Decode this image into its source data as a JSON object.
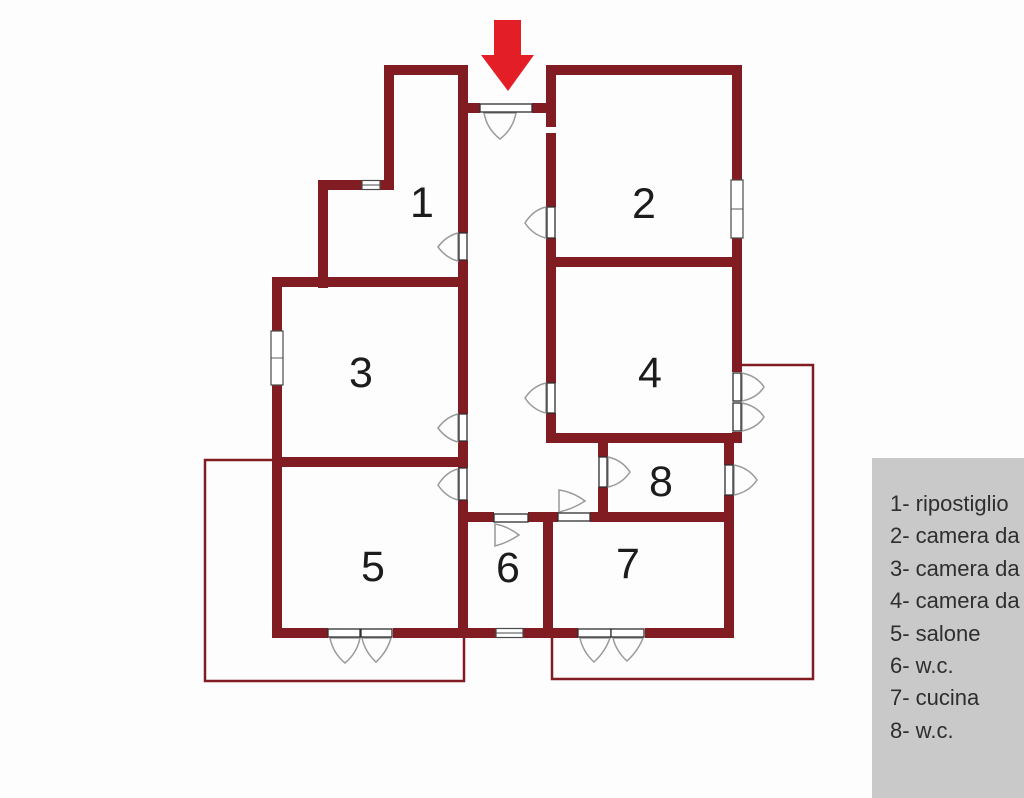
{
  "floorplan": {
    "background": "#fdfdfd",
    "wall_color": "#821c23",
    "arrow_color": "#e31e26",
    "room_numbers": [
      "1",
      "2",
      "3",
      "4",
      "5",
      "6",
      "7",
      "8"
    ]
  },
  "legend": {
    "background": "#c9c9c9",
    "text_color": "#2e2e2e",
    "items": [
      "1- ripostiglio",
      "2- camera da",
      "3- camera da",
      "4- camera da",
      "5- salone",
      "6- w.c.",
      "7- cucina",
      "8- w.c."
    ]
  }
}
